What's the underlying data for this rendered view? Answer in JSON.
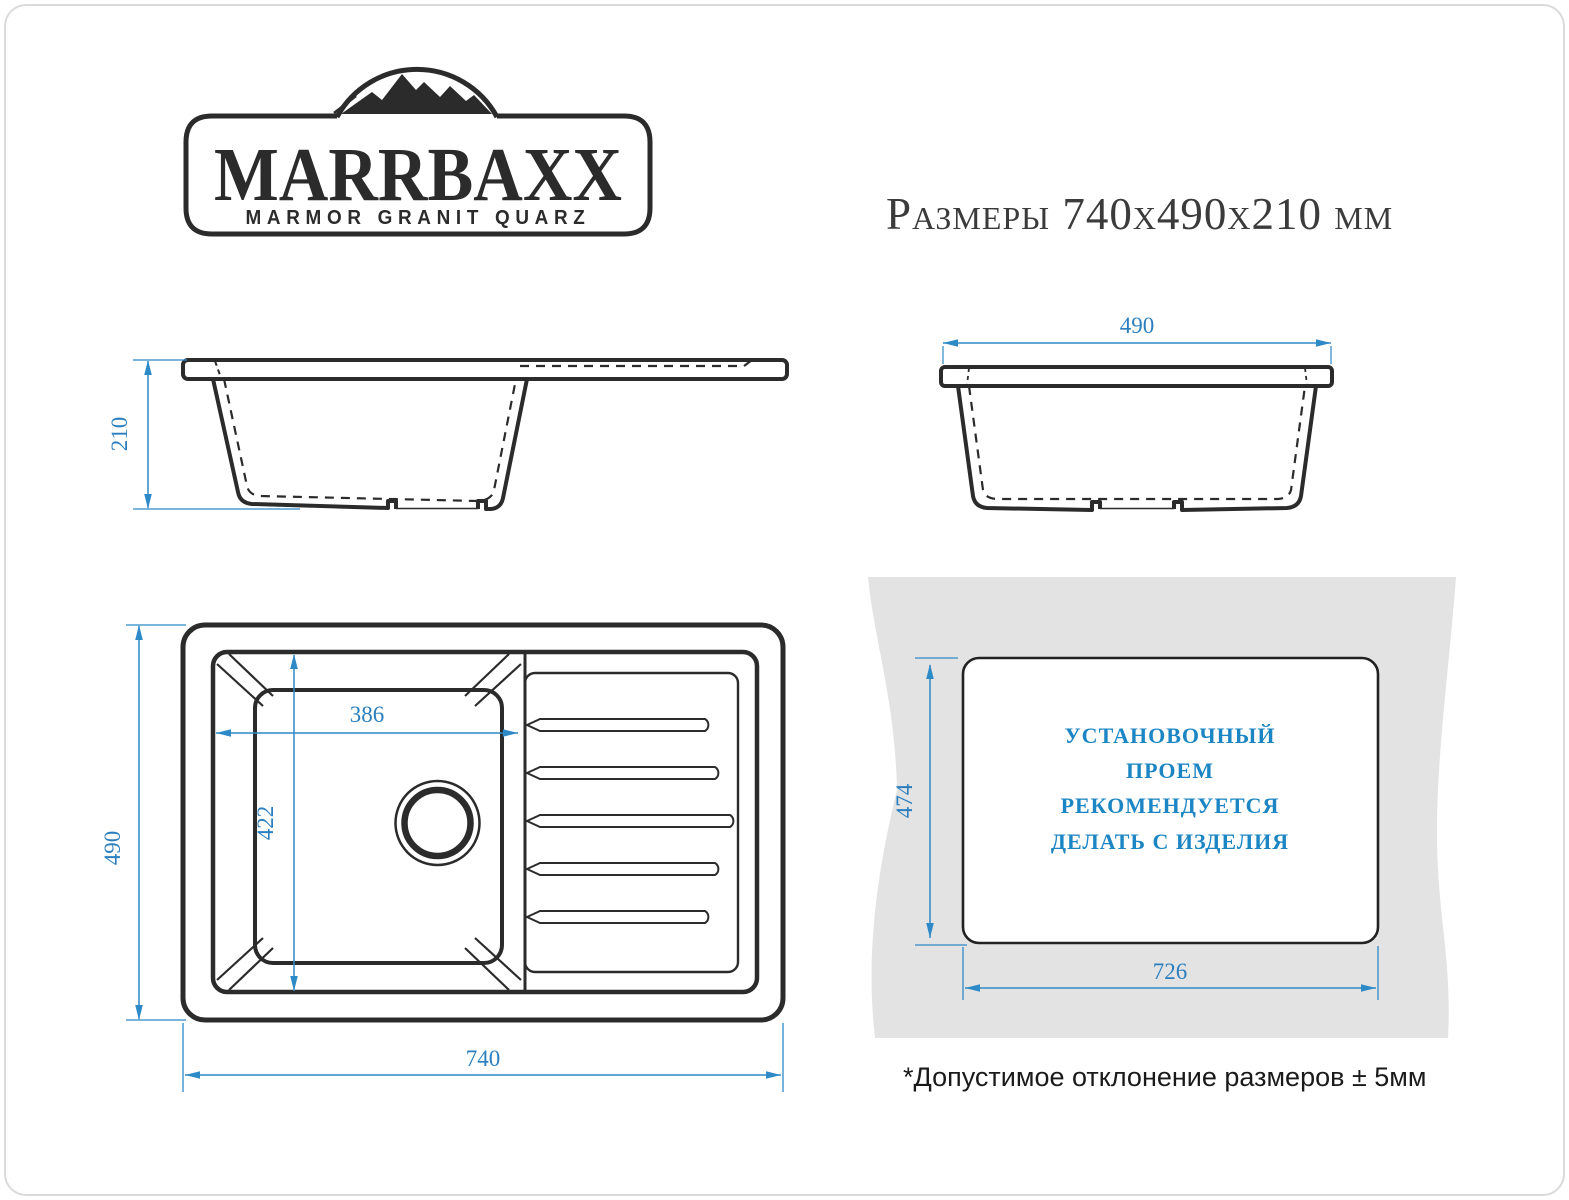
{
  "header": {
    "title": "Размеры 740х490х210 мм"
  },
  "logo": {
    "brand": "MARRBAXX",
    "tagline": "MARMOR GRANIT QUARZ"
  },
  "views": {
    "side": {
      "height_label": "210"
    },
    "front": {
      "width_label": "490"
    },
    "top": {
      "depth_label": "490",
      "length_label": "740",
      "bowl_width_label": "386",
      "bowl_depth_label": "422"
    }
  },
  "install": {
    "height_label": "474",
    "width_label": "726",
    "note_lines": [
      "УСТАНОВОЧНЫЙ",
      "ПРОЕМ",
      "РЕКОМЕНДУЕТСЯ",
      "ДЕЛАТЬ С ИЗДЕЛИЯ"
    ]
  },
  "footnote": "*Допустимое отклонение размеров ± 5мм",
  "colors": {
    "line_black": "#2B2B2B",
    "dimension_blue": "#2E89C7",
    "dimension_text_blue": "#2B7FBE",
    "note_blue": "#1B86C3",
    "panel_gray": "#E3E3E4"
  }
}
